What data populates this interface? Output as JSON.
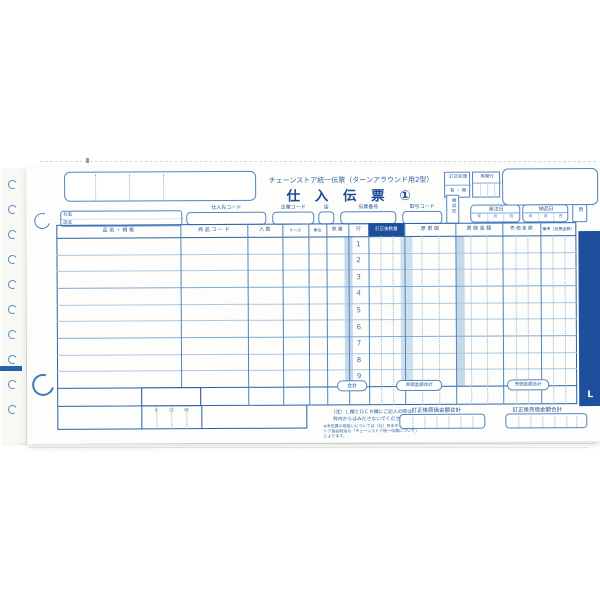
{
  "colors": {
    "ink_blue": "#2a62a8",
    "navy": "#1b4a90",
    "band_navy": "#1d4f9c",
    "shade_blue": "#c6d9e9",
    "paper": "#fdfdfb"
  },
  "header": {
    "title_sub": "チェーンストア統一伝票（ターンアラウンド用2型）",
    "title_main": "仕 入 伝 票 ①",
    "correction_label": "訂正処理",
    "correction_options": "有 ・ 無",
    "reissue_label": "再発行",
    "company_row1": "社名",
    "company_row2": "店名",
    "field_supplier": "仕入先コード",
    "field_company": "企業コード",
    "field_store": "店",
    "field_slip_no": "伝票番号",
    "field_trade": "取引コード",
    "inspection_label": "検収印",
    "order_date_label": "発注日",
    "delivery_date_label": "納品日",
    "date_units": {
      "y": "年",
      "m": "月",
      "d": "日"
    },
    "page_label": "頁"
  },
  "table": {
    "columns": [
      "品 名 ・ 規 格",
      "商 品 コ ー ド",
      "入 数",
      "ケース",
      "単位",
      "数 量",
      "行",
      "訂正後数量",
      "原 単 価",
      "原 価 金 額",
      "売 価 金 額",
      "備考（伝票金額）"
    ],
    "row_numbers": [
      "1",
      "2",
      "3",
      "4",
      "5",
      "6",
      "7",
      "8",
      "9"
    ],
    "tabs": [
      "合計",
      "原価金額合計",
      "売価金額合計"
    ]
  },
  "footer": {
    "note_line1": "（注）Ｌ欄とＯＣＲ欄にご記入の際は",
    "note_line2": "枠内からはみださないでください。",
    "fine_print": "※本伝票の取扱いについては（社）日本チェーンストア協会制定の「チェーンストア統一伝票について」によります。",
    "cost_total_label": "訂正後原価金額合計",
    "retail_total_label": "訂正後売価金額合計",
    "l_mark": "L",
    "ticks": [
      "8",
      "12",
      "16"
    ]
  }
}
